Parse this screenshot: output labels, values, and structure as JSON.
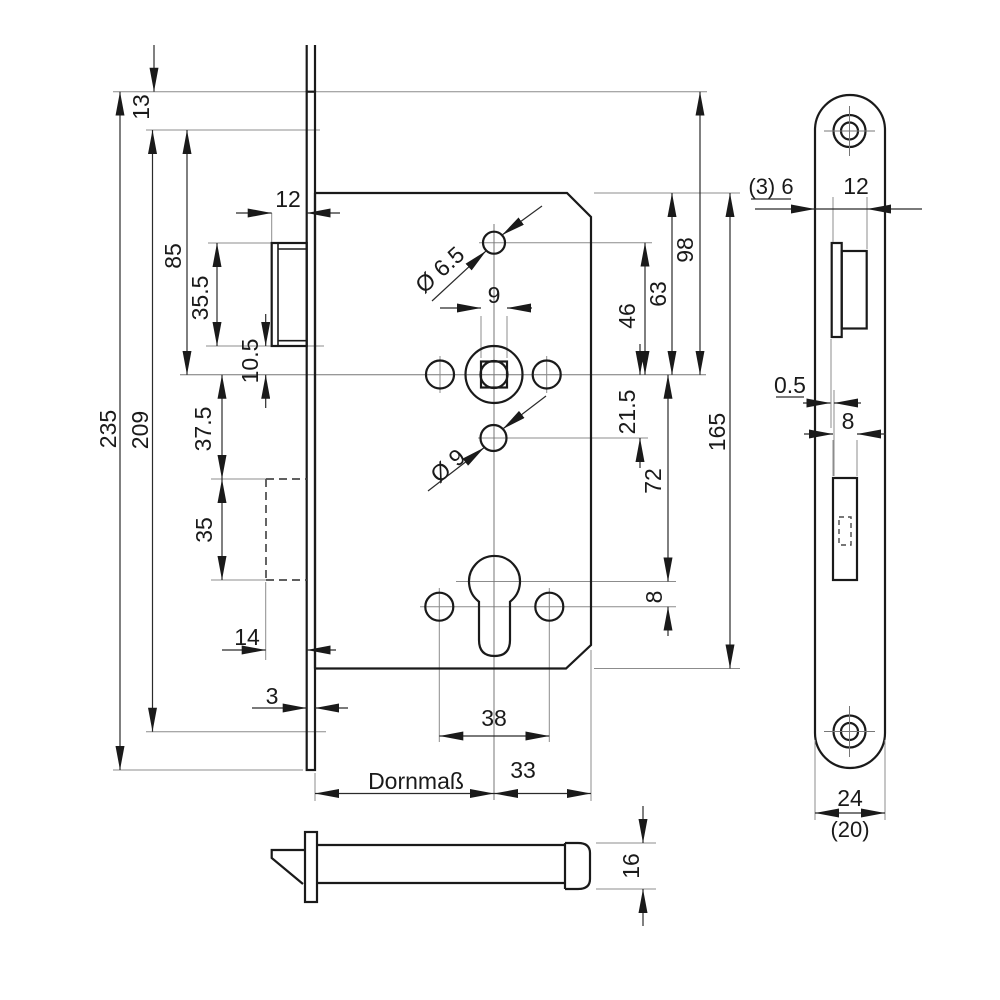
{
  "drawing": {
    "kind": "technical dimensional drawing",
    "subject": "mortise door lock with euro profile cylinder, faceplate and latch bolt views",
    "colors": {
      "line": "#1a1a1a",
      "dimension": "#2b2b2b",
      "extension": "#8c8c8c",
      "background": "#ffffff"
    }
  },
  "labels": {
    "d13": "13",
    "d235": "235",
    "d209": "209",
    "d85": "85",
    "d35_5": "35.5",
    "d10_5": "10.5",
    "d37_5": "37.5",
    "d35": "35",
    "d12_top": "12",
    "d14": "14",
    "d3": "3",
    "dia6_5": "Ø 6.5",
    "d9_square": "9",
    "dia9": "Ø 9",
    "d38": "38",
    "dornmass": "Dornmaß",
    "d33": "33",
    "d98": "98",
    "d63": "63",
    "d46": "46",
    "d21_5": "21.5",
    "d72": "72",
    "d8_right": "8",
    "d165": "165",
    "fp_offset": "(3) 6",
    "fp_width": "12",
    "fp_gap": "0.5",
    "fp_bolt": "8",
    "fp_24": "24",
    "fp_20": "(20)",
    "d16": "16"
  }
}
